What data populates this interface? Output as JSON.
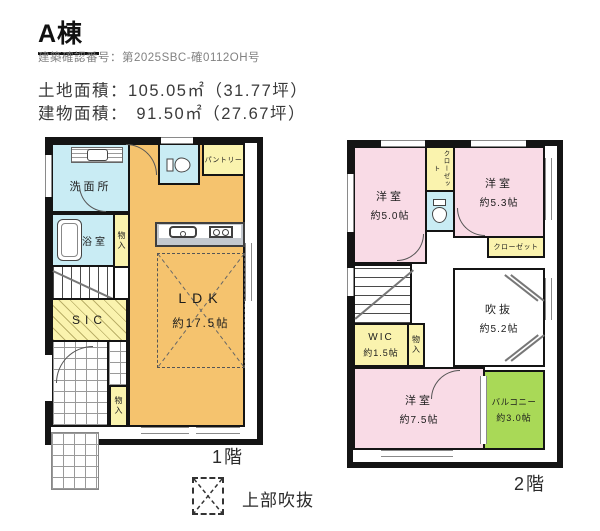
{
  "header": {
    "title": "A棟",
    "confirmation_number": "建築確認番号：第2025SBC-確0112OH号",
    "land_area_label": "土地面積：",
    "land_area_value": "105.05㎡（31.77坪）",
    "building_area_label": "建物面積：",
    "building_area_value": "91.50㎡（27.67坪）"
  },
  "floor1": {
    "floor_label": "1階",
    "washroom": "洗面所",
    "bathroom": "浴室",
    "storage_bath": "物入",
    "pantry": "パントリー",
    "sic": "SIC",
    "storage_entry": "物入",
    "ldk_name": "LDK",
    "ldk_size": "約17.5帖"
  },
  "floor2": {
    "floor_label": "2階",
    "bedroom_a_name": "洋室",
    "bedroom_a_size": "約5.0帖",
    "closet_top": "クローゼット",
    "bedroom_b_name": "洋室",
    "bedroom_b_size": "約5.3帖",
    "closet_right": "クローゼット",
    "void_name": "吹抜",
    "void_size": "約5.2帖",
    "wic_name": "WIC",
    "wic_size": "約1.5帖",
    "storage": "物入",
    "bedroom_c_name": "洋室",
    "bedroom_c_size": "約7.5帖",
    "balcony_name": "バルコニー",
    "balcony_size": "約3.0帖"
  },
  "legend": {
    "upper_void": "上部吹抜"
  },
  "colors": {
    "wall": "#141414",
    "ldk_orange": "#f5c36e",
    "wet_blue": "#c9ecf4",
    "storage_yellow": "#faf3ae",
    "bedroom_pink": "#f9dbe6",
    "balcony_green": "#a9d957"
  }
}
